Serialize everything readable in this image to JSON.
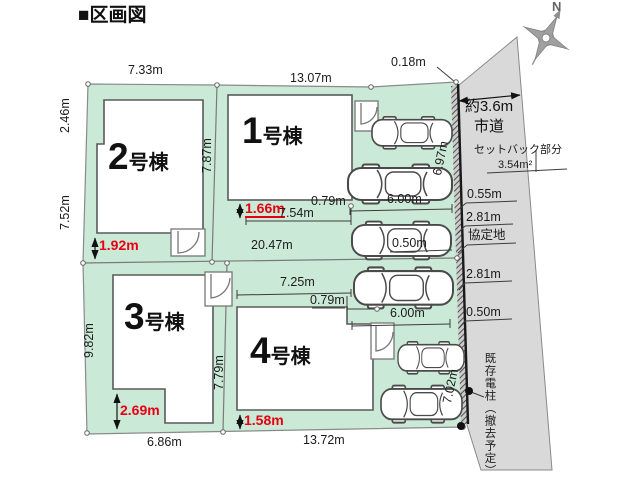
{
  "title": "■区画図",
  "compass": {
    "north": "N"
  },
  "buildings": [
    {
      "num": "1",
      "suffix": "号棟"
    },
    {
      "num": "2",
      "suffix": "号棟"
    },
    {
      "num": "3",
      "suffix": "号棟"
    },
    {
      "num": "4",
      "suffix": "号棟"
    }
  ],
  "road": {
    "width": "約3.6m",
    "type": "市道",
    "setback": "セットバック部分",
    "setback_area": "3.54m²",
    "d_055": "0.55m",
    "d_281a": "2.81m",
    "agreement": "協定地",
    "d_281b": "2.81m",
    "d_050b": "0.50m",
    "pole": "既存電柱（撤去予定）"
  },
  "dims": {
    "top_gap": "0.18m",
    "lot2_top": "7.33m",
    "lot1_top": "13.07m",
    "left_a": "2.46m",
    "left_b": "7.52m",
    "div12": "7.87m",
    "b2_red": "1.92m",
    "b1_red": "1.66m",
    "b1_bottom": "7.54m",
    "b1_step": "0.79m",
    "park_a": "6.00m",
    "right_a": "6.97m",
    "car_gap": "0.50m",
    "total": "20.47m",
    "left_c": "9.82m",
    "div34": "7.79m",
    "b4_top": "7.25m",
    "b4_step": "0.79m",
    "park_b": "6.00m",
    "b3_red": "2.69m",
    "b4_red": "1.58m",
    "lot3_bottom": "6.86m",
    "lot4_bottom": "13.72m",
    "right_b": "7.02m"
  }
}
